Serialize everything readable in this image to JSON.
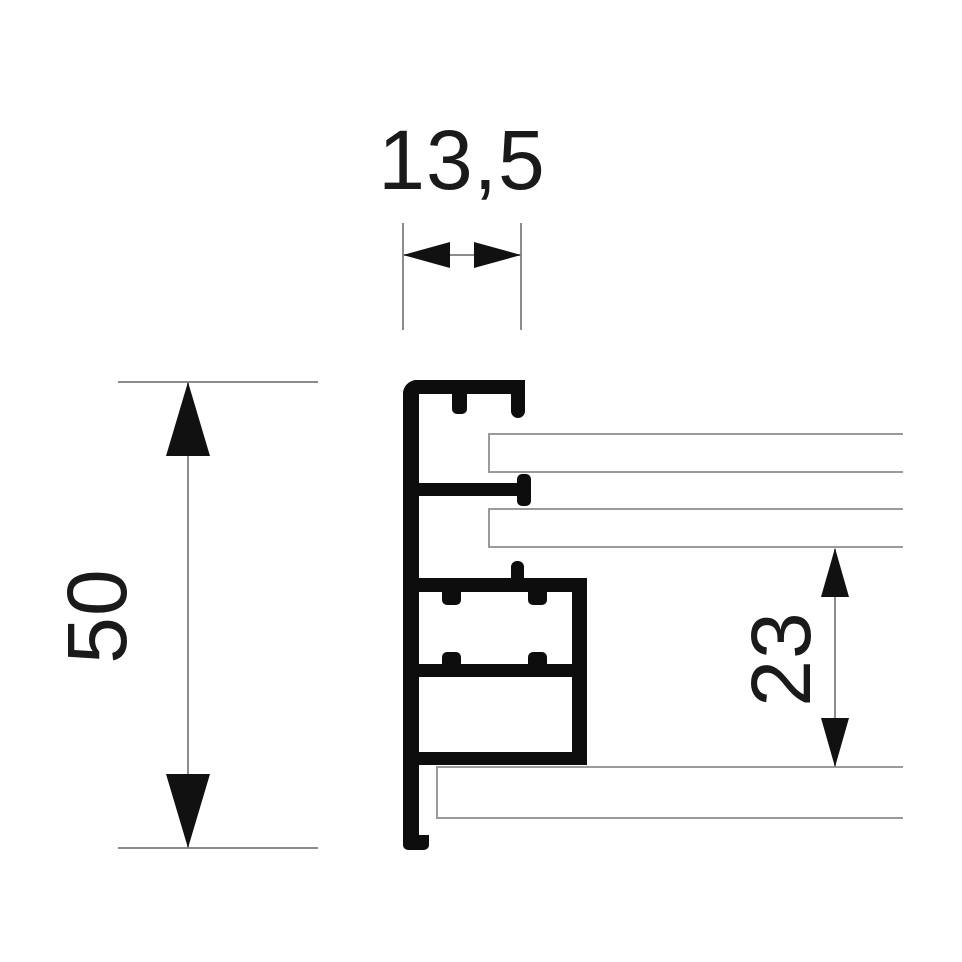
{
  "diagram": {
    "type": "technical-drawing",
    "subject": "aluminium-frame-profile-cross-section",
    "dimensions": {
      "top_width": {
        "label": "13,5"
      },
      "overall_height": {
        "label": "50"
      },
      "right_offset": {
        "label": "23"
      }
    },
    "colors": {
      "profile": "#0d0d0d",
      "panel-edge": "#9a9a9a",
      "dim-line": "#8c8c8c",
      "arrow": "#111111",
      "text": "#1a1a1a",
      "bg": "#ffffff"
    }
  }
}
